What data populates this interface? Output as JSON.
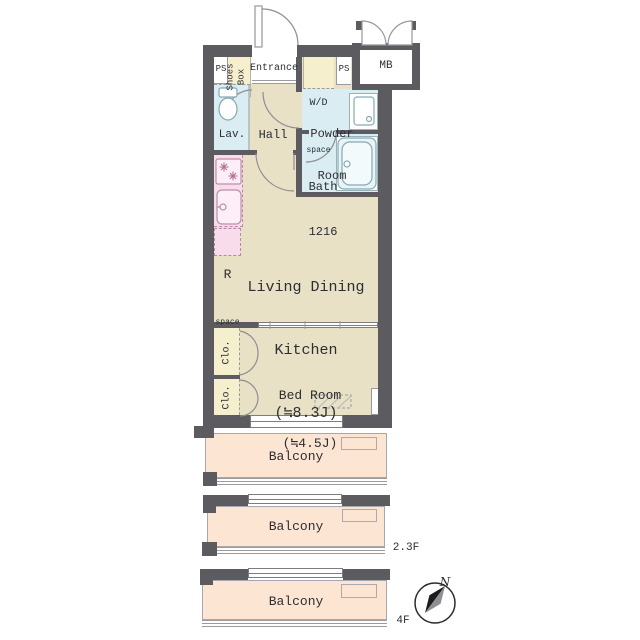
{
  "title": "Apartment floor plan",
  "labels": {
    "ps_left": "PS",
    "shoes_box_line1": "Shoes",
    "shoes_box_line2": "Box",
    "entrance": "Entrance",
    "wd_line1": "W/D",
    "wd_line2": "space",
    "ps_right": "PS",
    "mb": "MB",
    "lav": "Lav.",
    "hall": "Hall",
    "powder_line1": "Powder",
    "powder_line2": "Room",
    "bath_line1": "Bath",
    "bath_line2": "1216",
    "r_line1": "R",
    "r_line2": "space",
    "ldk_line1": "Living Dining",
    "ldk_line2": "Kitchen",
    "ldk_line3": "(≒8.3J)",
    "bed_line1": "Bed Room",
    "bed_line2": "(≒4.5J)",
    "clo_upper": "Clo.",
    "clo_lower": "Clo.",
    "balcony1": "Balcony",
    "balcony2": "Balcony",
    "balcony3": "Balcony",
    "floor_mid": "2.3F",
    "floor_bottom": "4F",
    "compass_north": "N"
  },
  "colors": {
    "wall": "#5b5b60",
    "room_beige": "#e8e1c5",
    "wet_blue": "#d9edf2",
    "kitchen_pink": "#f9dcec",
    "storage_yellow": "#f5efcd",
    "balcony_peach": "#fce5d2",
    "line_gray": "#8f8f95",
    "text_ink": "#2e2e32",
    "fixture_pink_stroke": "#c08da9",
    "fixture_blue_stroke": "#86a9b4",
    "compass_gray": "#8e8e93"
  }
}
